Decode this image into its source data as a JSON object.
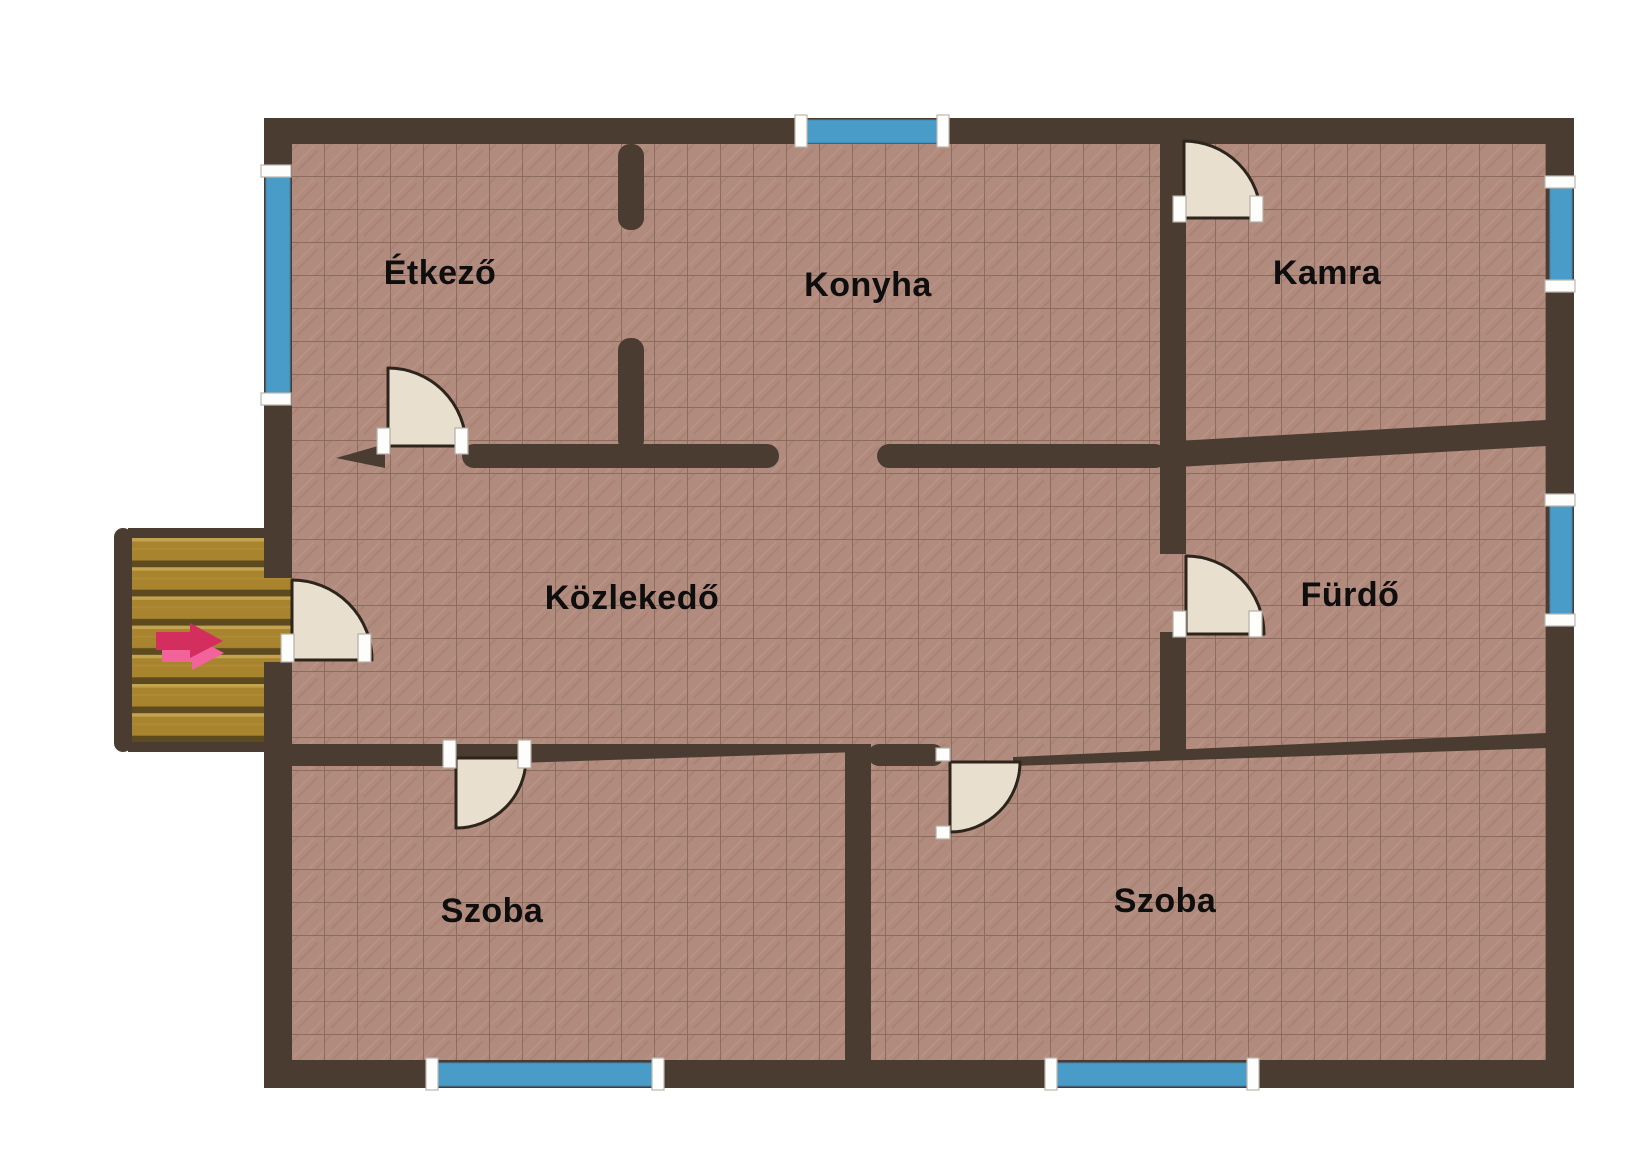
{
  "floorplan": {
    "rooms": [
      {
        "name": "etkezo",
        "label": "Étkező"
      },
      {
        "name": "konyha",
        "label": "Konyha"
      },
      {
        "name": "kamra",
        "label": "Kamra"
      },
      {
        "name": "kozlekedo",
        "label": "Közlekedő"
      },
      {
        "name": "furdo",
        "label": "Fürdő"
      },
      {
        "name": "szoba-left",
        "label": "Szoba"
      },
      {
        "name": "szoba-right",
        "label": "Szoba"
      }
    ],
    "doors": {
      "count": 6,
      "locations": [
        "entrance-left-wall",
        "etkezo",
        "kamra",
        "furdo",
        "szoba-left",
        "szoba-right"
      ]
    },
    "windows": {
      "count": 6,
      "locations": [
        "etkezo-left",
        "konyha-top",
        "kamra-right",
        "furdo-right",
        "szoba-left-bottom",
        "szoba-right-bottom"
      ]
    },
    "staircase": {
      "steps": 7,
      "position": "outside-left",
      "entrance_arrow_direction": "right"
    },
    "colors": {
      "background": "#ffffff",
      "wall": "#4b3c32",
      "floor_tile": "#b18b7d",
      "floor_grid": "#7e6254",
      "window_glass": "#4a9cc8",
      "door_leaf": "#e9dfcf",
      "stairs_wood": "#a8842f",
      "arrow_dark": "#d32e5e",
      "arrow_light": "#f2639c",
      "label_text": "#0e0e0e"
    }
  }
}
